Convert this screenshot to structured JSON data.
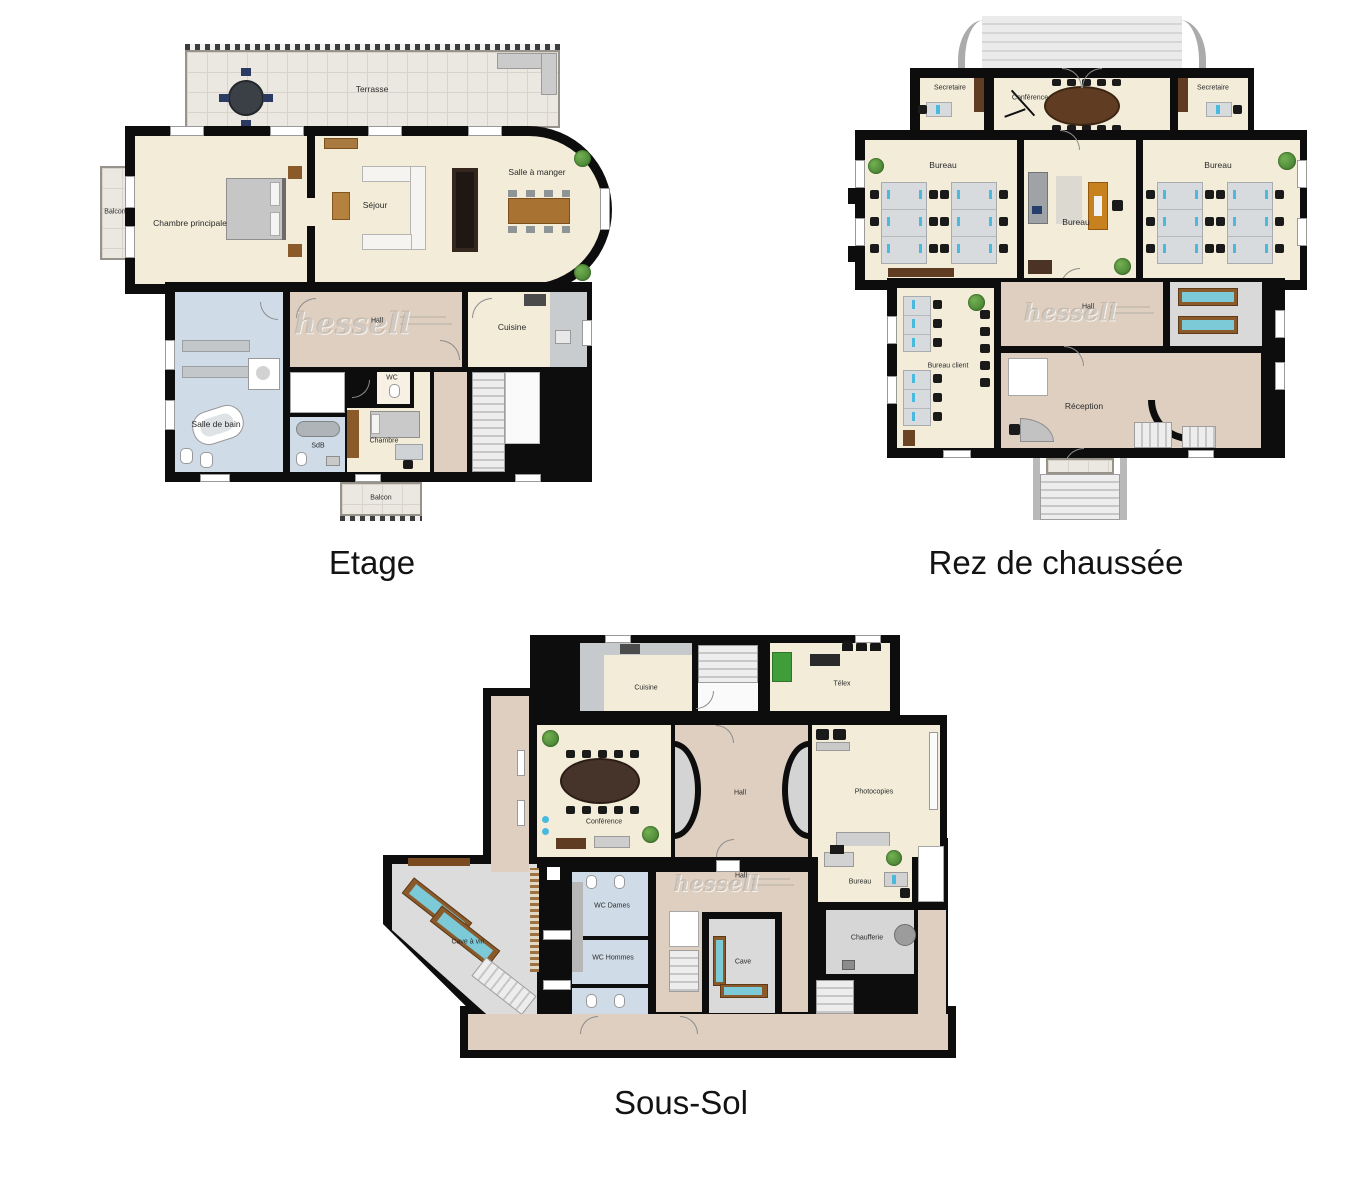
{
  "palette": {
    "wall": "#0d0d0d",
    "room_cream": "#f2ecd9",
    "hall_tan": "#decfc0",
    "bath_blue": "#cfdbe7",
    "utility_gray": "#d9d9d9",
    "plant_green": "#3c762b",
    "screen_cyan": "#49b9dd",
    "wood": "#8a5a2b",
    "title_text": "#131313"
  },
  "plans": {
    "etage": {
      "title": "Etage",
      "watermark": "hessell",
      "rooms": {
        "terrasse": "Terrasse",
        "balcon_gauche": "Balcon",
        "chambre_principale": "Chambre principale",
        "sejour": "Séjour",
        "salle_a_manger": "Salle à manger",
        "hall": "Hall",
        "cuisine": "Cuisine",
        "salle_de_bain": "Salle de bain",
        "sdb": "SdB",
        "wc": "WC",
        "chambre": "Chambre",
        "balcon_bas": "Balcon"
      }
    },
    "rdc": {
      "title": "Rez de chaussée",
      "watermark": "hessell",
      "rooms": {
        "secretaire_gauche": "Secretaire",
        "conference": "Conférence",
        "secretaire_droit": "Secretaire",
        "bureau_gauche": "Bureau",
        "bureau_centre": "Bureau",
        "bureau_droit": "Bureau",
        "bureau_client": "Bureau client",
        "hall": "Hall",
        "reception": "Réception"
      }
    },
    "soussol": {
      "title": "Sous-Sol",
      "watermark": "hessell",
      "rooms": {
        "cuisine": "Cuisine",
        "telex": "Télex",
        "conference": "Conférence",
        "hall_haut": "Hall",
        "photocopies": "Photocopies",
        "cave_a_vin": "Cave à vin",
        "wc_dames": "WC Dames",
        "wc_hommes": "WC Hommes",
        "hall_bas": "Hall",
        "cave": "Cave",
        "bureau": "Bureau",
        "chaufferie": "Chaufferie"
      }
    }
  }
}
